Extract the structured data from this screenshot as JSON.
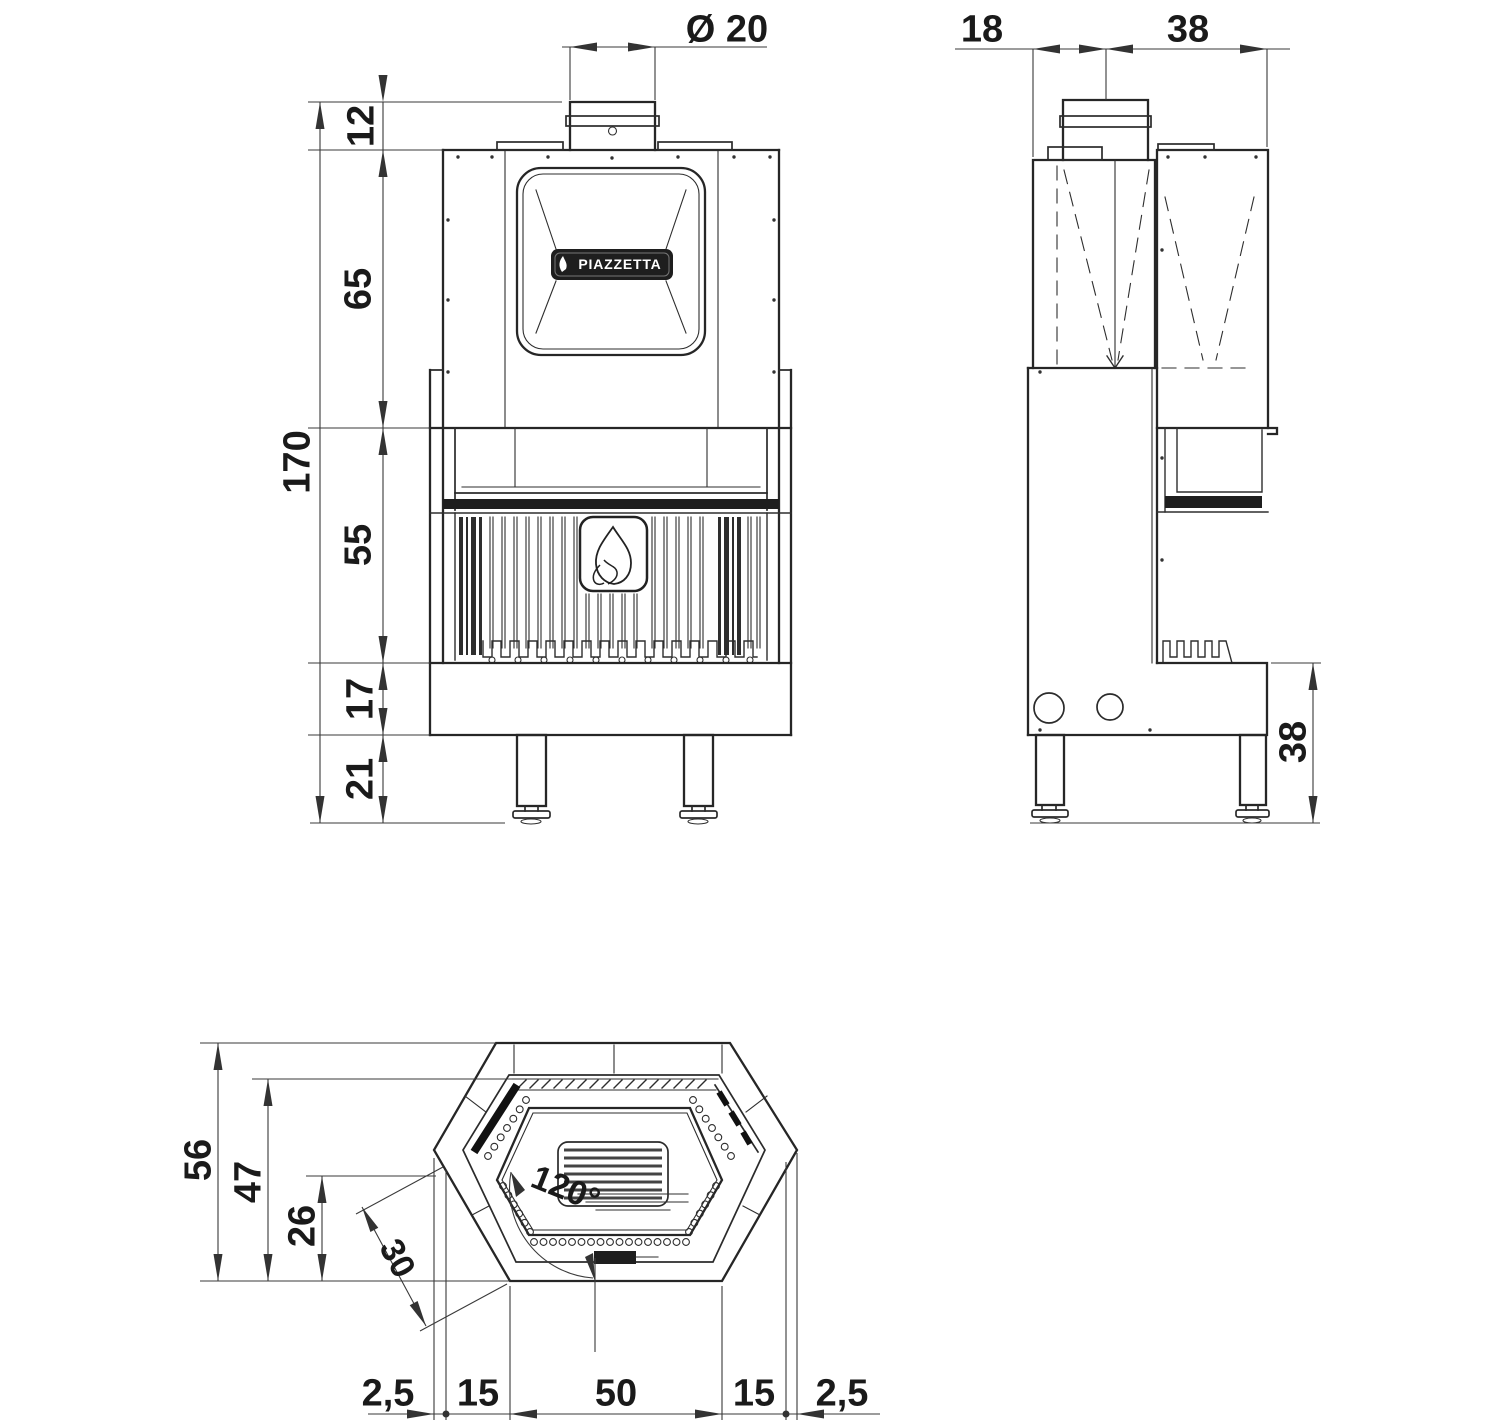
{
  "drawing": {
    "brand_label": "PIAZZETTA",
    "front_view": {
      "flue_diameter_label": "Ø 20",
      "dim_top_offset": "12",
      "dim_upper_section": "65",
      "dim_total_height": "170",
      "dim_firebox": "55",
      "dim_base": "17",
      "dim_legs": "21"
    },
    "side_view": {
      "dim_back_depth": "18",
      "dim_front_depth": "38",
      "dim_plinth_height": "38"
    },
    "plan_view": {
      "dim_total_depth": "56",
      "dim_inner_depth": "47",
      "dim_front_depth": "26",
      "dim_glass_angle": "120°",
      "dim_side_face": "30",
      "dim_width_chain": [
        "2,5",
        "15",
        "50",
        "15",
        "2,5"
      ]
    },
    "colors": {
      "line": "#2b2b2b",
      "dimension": "#3a3a3a",
      "dark_fill": "#1e1e1e",
      "background": "#ffffff"
    }
  }
}
